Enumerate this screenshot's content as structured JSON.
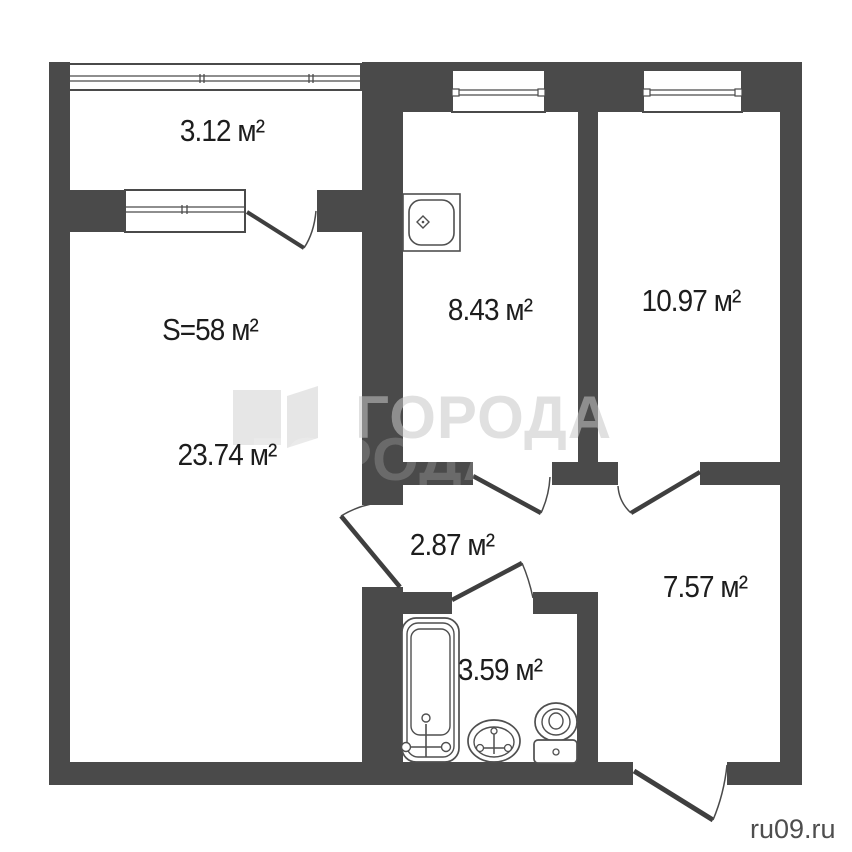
{
  "colors": {
    "wall": "#4a4a4a",
    "outline": "#4f4f4f",
    "door_leaf": "#3f3f3f",
    "label_text": "#1d1d1d",
    "watermark_text": "rgba(199,199,199,0.55)",
    "watermark_ghost": "rgba(255,255,255,0.18)",
    "site_text": "#4e4e4e",
    "background": "#ffffff"
  },
  "rooms": {
    "balcony": {
      "area_label": "3.12 м²"
    },
    "kitchen": {
      "area_label": "8.43 м²"
    },
    "bedroom": {
      "area_label": "10.97 м²"
    },
    "living_total together": "",
    "living_total": {
      "area_label": "S=58 м²"
    },
    "living": {
      "area_label": "23.74 м²"
    },
    "hallway": {
      "area_label": "2.87 м²"
    },
    "bathroom": {
      "area_label": "3.59 м²"
    },
    "entry": {
      "area_label": "7.57 м²"
    }
  },
  "watermark": {
    "brand_text": "ГОРОДА",
    "site_url": "ru09.ru"
  }
}
